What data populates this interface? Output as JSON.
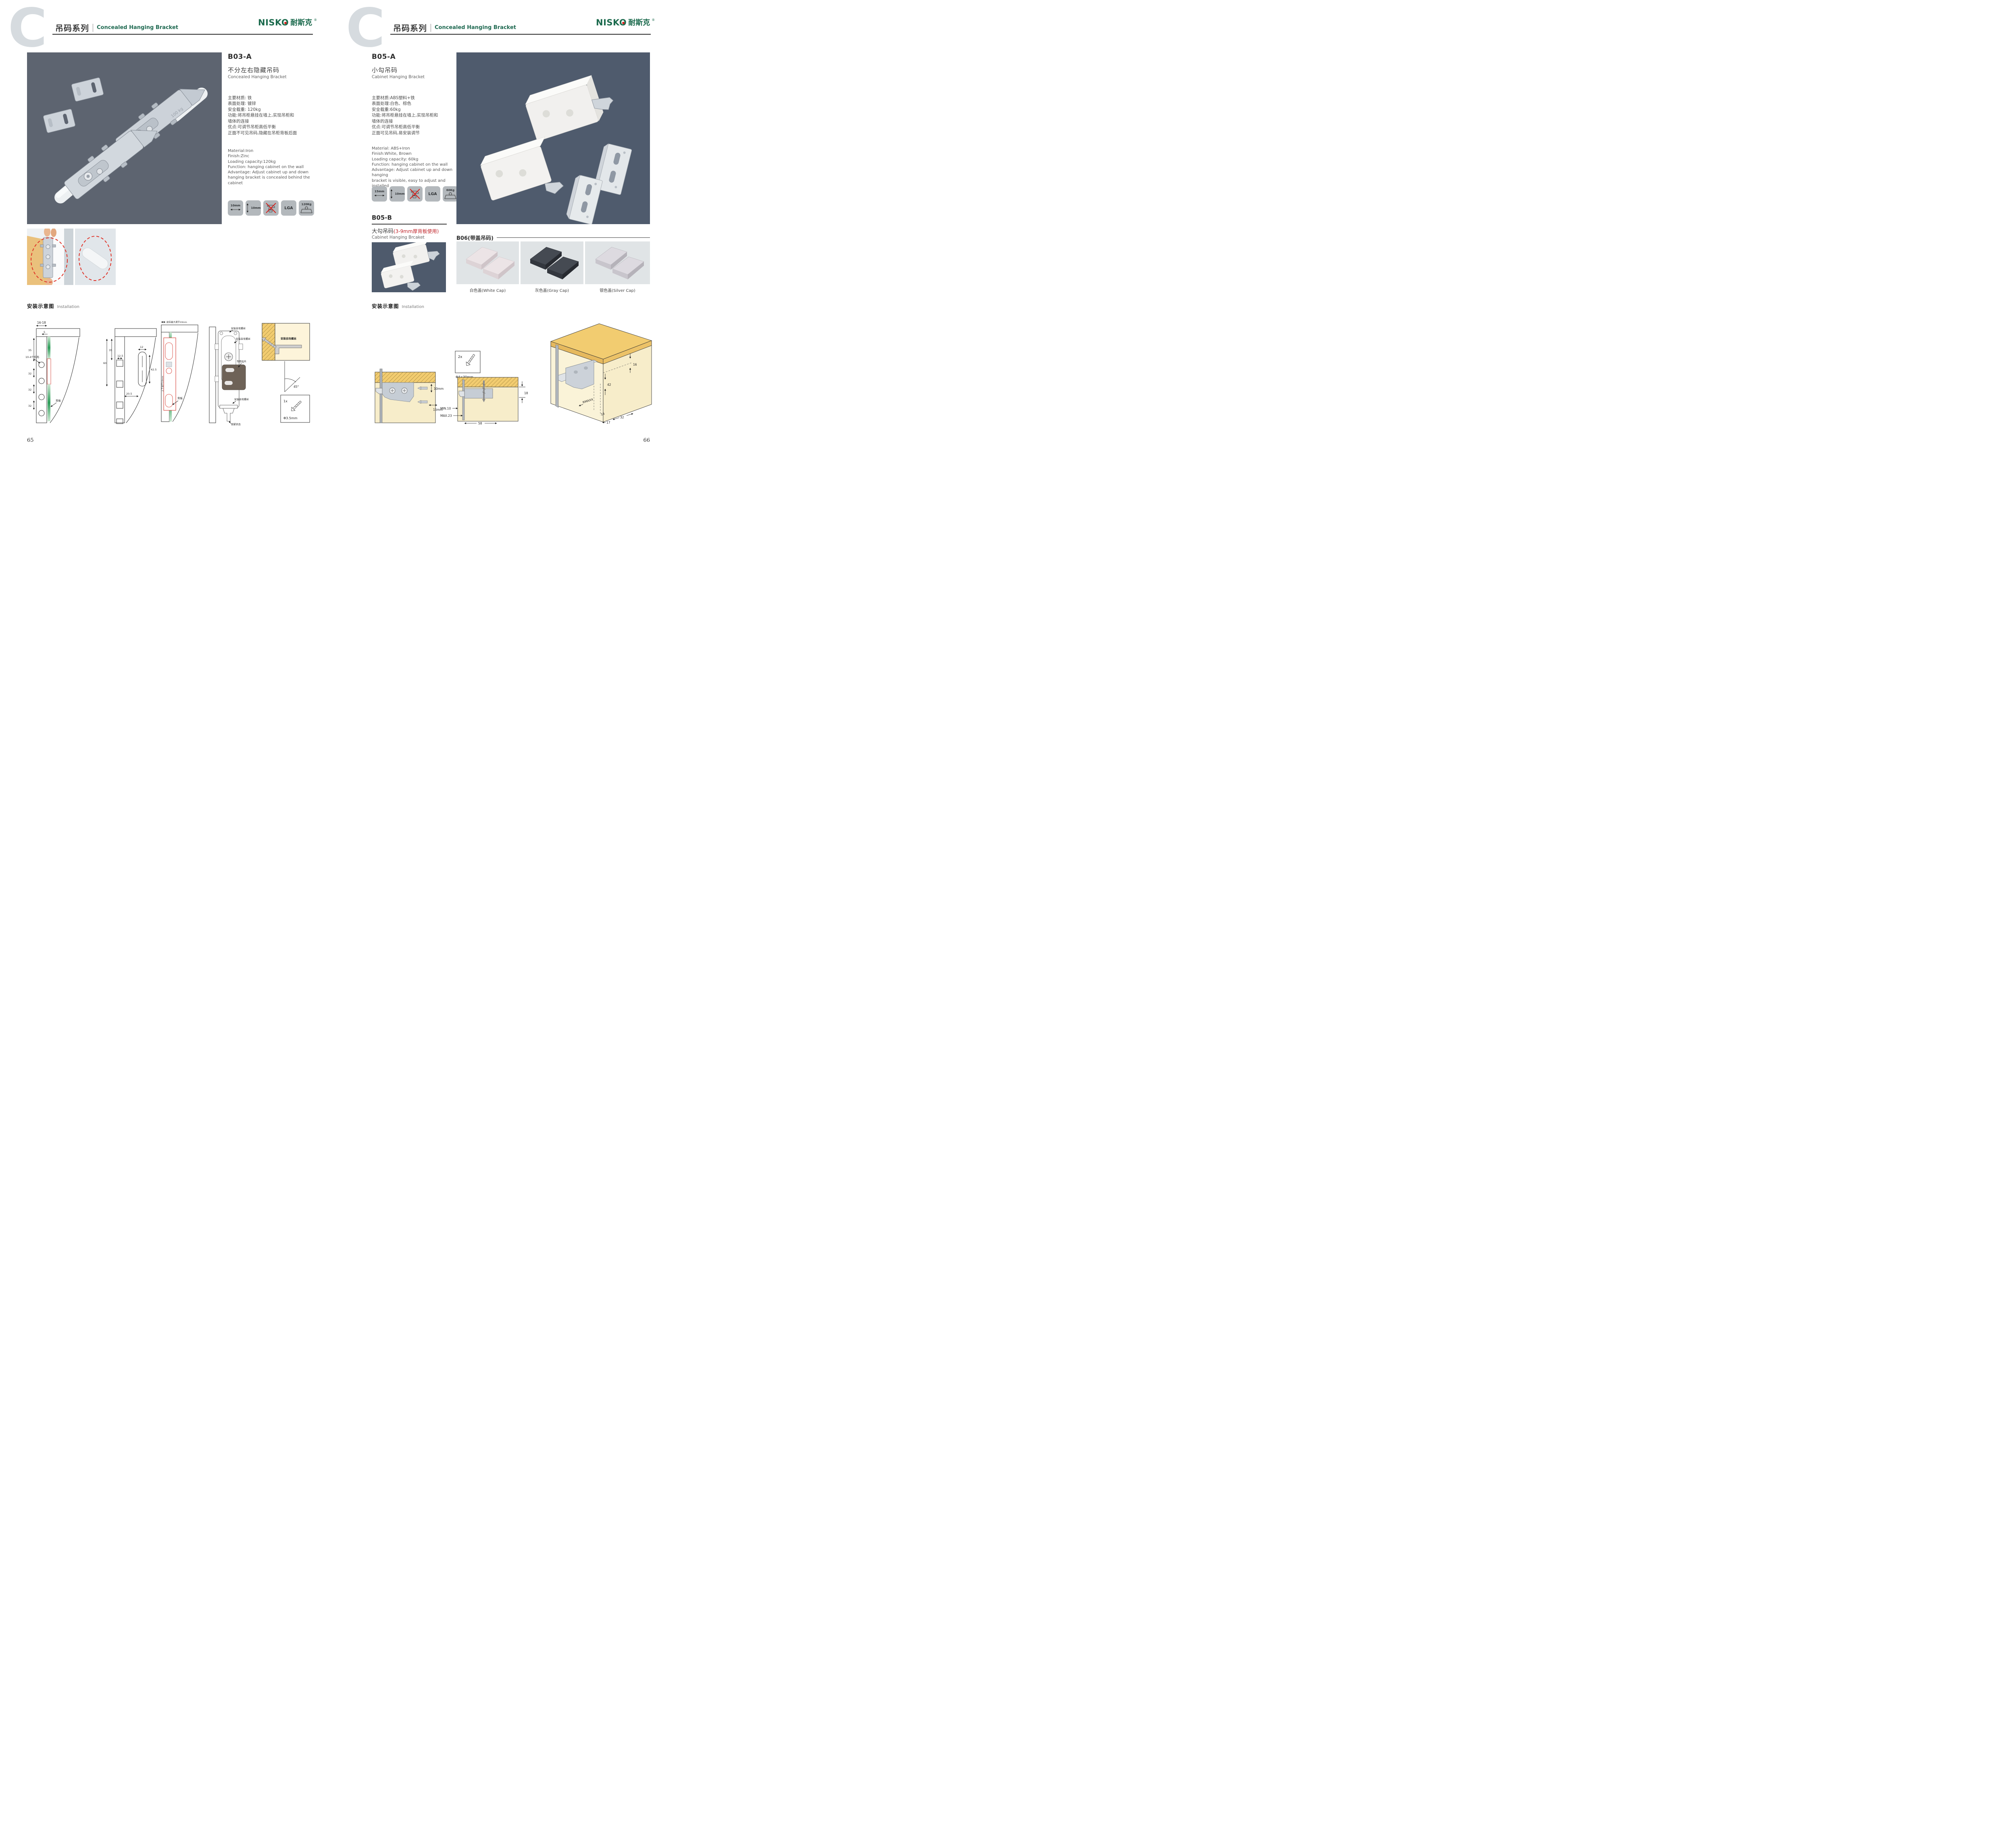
{
  "header": {
    "watermark": "C",
    "series_cn": "吊码系列",
    "series_en": "Concealed Hanging Bracket"
  },
  "brand": {
    "en": "NISKO",
    "cn": "耐斯克",
    "reg": "®",
    "green": "#1b6a4d",
    "red": "#d8231f"
  },
  "products": {
    "b03a": {
      "code": "B03-A",
      "name_cn": "不分左右隐藏吊码",
      "name_en": "Concealed Hanging Bracket",
      "specs_cn": [
        "主要材质: 铁",
        "表面处理: 镀锌",
        "安全载重: 120kg",
        "功能:将吊柜悬挂在墙上,实现吊柜和",
        "墙体的连接",
        "优点:可调节吊柜高低平衡",
        "正面不可见吊码,隐藏在吊柜背板后面"
      ],
      "specs_en": [
        "Material:Iron",
        "Finish:Zinc",
        "Loading capacity:120kg",
        "Function: hanging cabinet on the wall",
        "Advantage: Adjust cabinet up and down",
        "hanging bracket is concealed behind the cabinet"
      ],
      "icons": {
        "width": "10mm",
        "height": "10mm",
        "cert": "LGA",
        "load": "120Kg"
      },
      "engraving": "100 kg"
    },
    "b05a": {
      "code": "B05-A",
      "name_cn": "小勾吊码",
      "name_en": "Cabinet Hanging Bracket",
      "specs_cn": [
        "主要材质:ABS塑料+铁",
        "表面处理:白色、棕色",
        "安全载重:60kg",
        "功能:将吊柜悬挂在墙上,实现吊柜和",
        "墙体的连接",
        "优点:可调节吊柜高低平衡",
        "正面可见吊码,易安装调节"
      ],
      "specs_en": [
        "Material: ABS+Iron",
        "Finish:White, Brown",
        "Loading capacity: 60kg",
        "Function: hanging cabinet on the wall",
        "Advantage: Adjust cabinet up and down hanging",
        "bracket is visible, easy to adjust and installed"
      ],
      "icons": {
        "width": "15mm",
        "height": "10mm",
        "cert": "LGA",
        "load": "60Kg"
      }
    },
    "b05b": {
      "code": "B05-B",
      "name_cn": "大勾吊码",
      "note_red": "(3-9mm厚背板使用)",
      "name_en": "Cabinet Hanging Brcaket"
    },
    "b06": {
      "title": "B06(带盖吊码)",
      "caps": [
        {
          "label": "白色盖(White Cap)"
        },
        {
          "label": "灰色盖(Gray Cap)"
        },
        {
          "label": "银色盖(Silver Cap)"
        }
      ]
    }
  },
  "installation": {
    "title_cn": "安装示意图",
    "title_en": "Installation",
    "left": {
      "d1": {
        "w": "16-18",
        "edge": "5",
        "top": "35",
        "s1": "32",
        "s2": "32",
        "s3": "32",
        "callout": "10-4个均布",
        "back": "背板"
      },
      "d2": {
        "v1": "60",
        "v2": "35",
        "w1": "12.5",
        "w2": "12",
        "h1": "42.5",
        "h2": "20.5"
      },
      "d3": {
        "top": "前后最大调节10mm",
        "side": "上下调节10mm",
        "back": "背板"
      },
      "d4": {
        "screw1": "安装自攻螺丝",
        "screw2": "安装自攻螺丝",
        "screw3": "安装自攻螺丝",
        "part": "专用挂片",
        "lock": "锁紧状态"
      },
      "d5": {
        "screw": "安装自攻螺丝",
        "angle": "45°",
        "qty": "1x",
        "size": "Φ3.5mm"
      }
    },
    "right": {
      "d1": {
        "v": "10mm",
        "h": "15mm"
      },
      "screws": {
        "qty": "2x",
        "size": "Φ4×30mm"
      },
      "d2": {
        "h": "18",
        "min": "MIN.10",
        "max": "MAX.23",
        "w": "58"
      },
      "d3": {
        "a": "16",
        "b": "42",
        "r": "RMAX4",
        "c": "16",
        "d": "17",
        "e": "32"
      }
    }
  },
  "footer": {
    "left": "65",
    "right": "66"
  }
}
